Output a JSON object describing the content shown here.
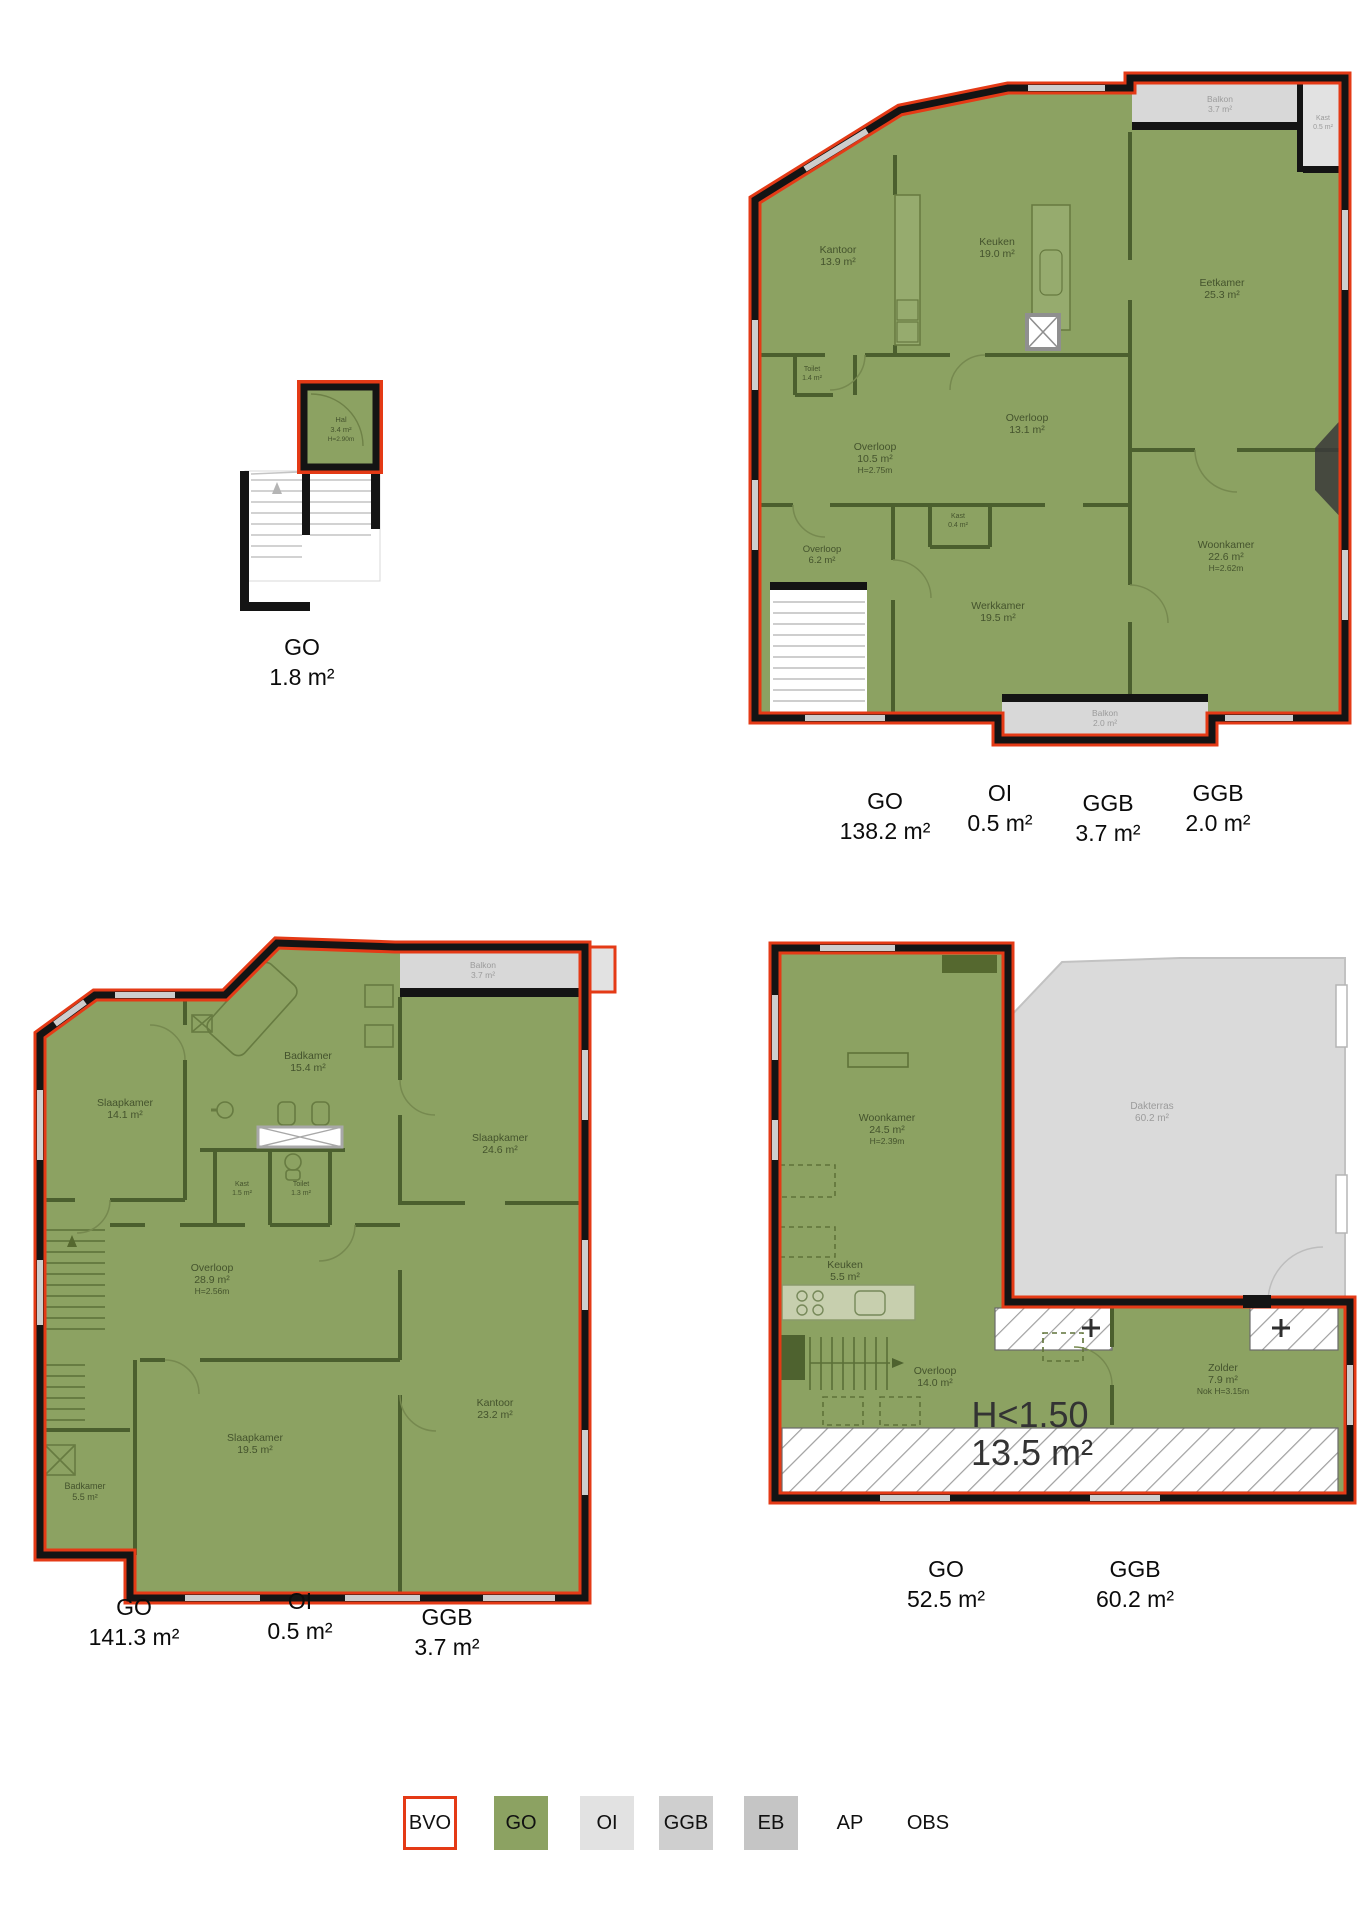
{
  "colors": {
    "bvo_red": "#E43A16",
    "go_green": "#8CA262",
    "oi_gray": "#E2E2E2",
    "ggb_gray": "#CFCFCF",
    "eb_gray": "#C5C5C5",
    "wall_black": "#141414"
  },
  "legend": {
    "items": [
      {
        "label": "BVO"
      },
      {
        "label": "GO"
      },
      {
        "label": "OI"
      },
      {
        "label": "GGB"
      },
      {
        "label": "EB"
      },
      {
        "label": "AP"
      },
      {
        "label": "OBS"
      }
    ]
  },
  "plans": {
    "p1": {
      "rooms": {
        "hal": {
          "name": "Hal",
          "area": "3.4 m²",
          "note": "H=2.90m"
        }
      },
      "summary": [
        {
          "label": "GO",
          "value": "1.8 m²"
        }
      ]
    },
    "p2": {
      "rooms": {
        "kantoor": {
          "name": "Kantoor",
          "area": "13.9 m²"
        },
        "keuken": {
          "name": "Keuken",
          "area": "19.0 m²"
        },
        "eetkamer": {
          "name": "Eetkamer",
          "area": "25.3 m²"
        },
        "toilet": {
          "name": "Toilet",
          "area": "1.4 m²"
        },
        "overloop_a": {
          "name": "Overloop",
          "area": "10.5 m²",
          "note": "H=2.75m"
        },
        "overloop_b": {
          "name": "Overloop",
          "area": "13.1 m²"
        },
        "kast": {
          "name": "Kast",
          "area": "0.4 m²"
        },
        "overloop_c": {
          "name": "Overloop",
          "area": "6.2 m²"
        },
        "werkkamer": {
          "name": "Werkkamer",
          "area": "19.5 m²"
        },
        "woonkamer": {
          "name": "Woonkamer",
          "area": "22.6 m²",
          "note": "H=2.62m"
        },
        "balkon_top": {
          "name": "Balkon",
          "area": "3.7 m²"
        },
        "kast_right": {
          "name": "Kast",
          "area": "0.5 m²"
        },
        "balkon_bottom": {
          "name": "Balkon",
          "area": "2.0 m²"
        }
      },
      "summary": [
        {
          "label": "GO",
          "value": "138.2 m²"
        },
        {
          "label": "OI",
          "value": "0.5 m²"
        },
        {
          "label": "GGB",
          "value": "3.7 m²"
        },
        {
          "label": "GGB",
          "value": "2.0 m²"
        }
      ]
    },
    "p3": {
      "rooms": {
        "slaapkamer1": {
          "name": "Slaapkamer",
          "area": "14.1 m²"
        },
        "badkamer1": {
          "name": "Badkamer",
          "area": "15.4 m²"
        },
        "slaapkamer2": {
          "name": "Slaapkamer",
          "area": "24.6 m²"
        },
        "kast": {
          "name": "Kast",
          "area": "1.5 m²"
        },
        "toilet": {
          "name": "Toilet",
          "area": "1.3 m²"
        },
        "overloop": {
          "name": "Overloop",
          "area": "28.9 m²",
          "note": "H=2.56m"
        },
        "kantoor": {
          "name": "Kantoor",
          "area": "23.2 m²"
        },
        "slaapkamer3": {
          "name": "Slaapkamer",
          "area": "19.5 m²"
        },
        "badkamer2": {
          "name": "Badkamer",
          "area": "5.5 m²"
        },
        "balkon": {
          "name": "Balkon",
          "area": "3.7 m²"
        }
      },
      "summary": [
        {
          "label": "GO",
          "value": "141.3 m²"
        },
        {
          "label": "OI",
          "value": "0.5 m²"
        },
        {
          "label": "GGB",
          "value": "3.7 m²"
        }
      ]
    },
    "p4": {
      "rooms": {
        "woonkamer": {
          "name": "Woonkamer",
          "area": "24.5 m²",
          "note": "H=2.39m"
        },
        "keuken": {
          "name": "Keuken",
          "area": "5.5 m²"
        },
        "overloop": {
          "name": "Overloop",
          "area": "14.0 m²"
        },
        "zolder": {
          "name": "Zolder",
          "area": "7.9 m²",
          "note": "Nok H=3.15m"
        },
        "dakterras": {
          "name": "Dakterras",
          "area": "60.2 m²"
        }
      },
      "lowheight": {
        "line1": "H<1.50",
        "line2": "13.5 m²"
      },
      "summary": [
        {
          "label": "GO",
          "value": "52.5 m²"
        },
        {
          "label": "GGB",
          "value": "60.2 m²"
        }
      ]
    }
  }
}
